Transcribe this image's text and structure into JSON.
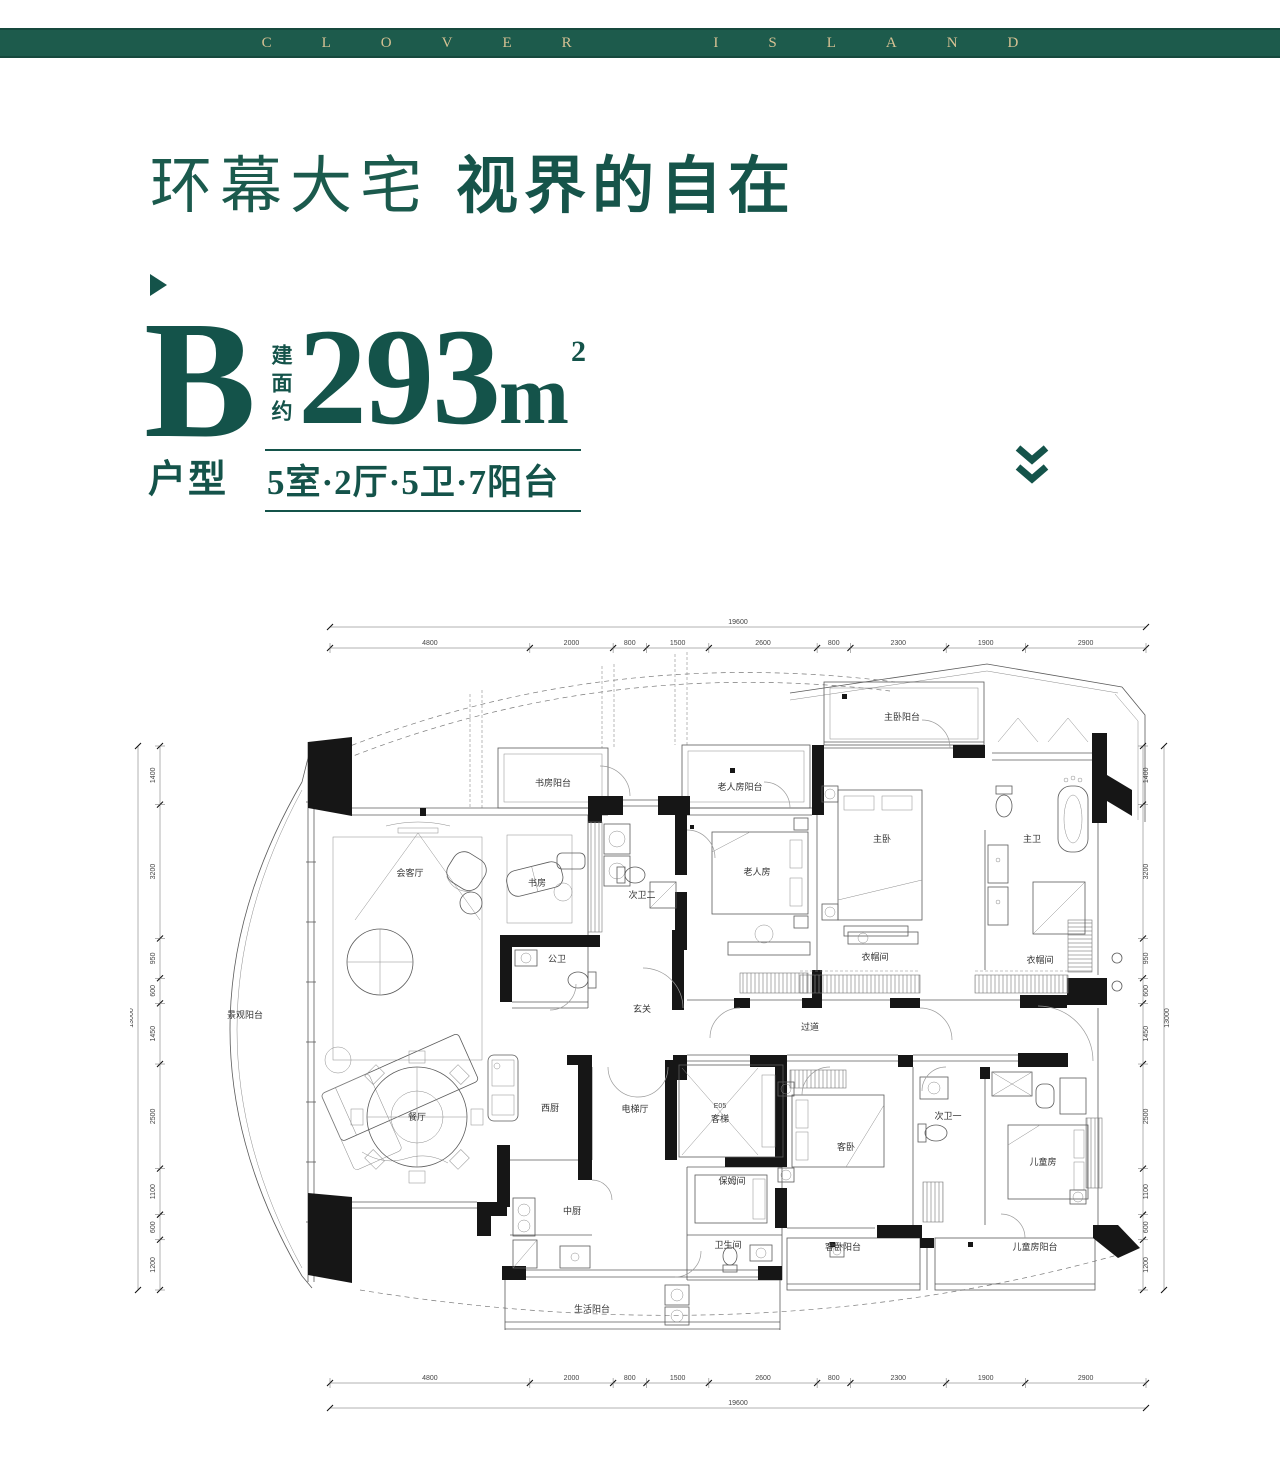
{
  "brand": {
    "name": "CLOVER ISLAND"
  },
  "title": {
    "light": "环幕大宅",
    "heavy": "视界的自在"
  },
  "unit": {
    "letter": "B",
    "type_label": "户型",
    "area_prefix": "建面约",
    "area_value": "293",
    "area_unit": "m",
    "area_sup": "2",
    "layout": "5室·2厅·5卫·7阳台"
  },
  "accent_color": "#14534a",
  "bar_color": "#1d5b4c",
  "gold_color": "#d6c193",
  "plan": {
    "rooms": [
      "景观阳台",
      "会客厅",
      "书房",
      "书房阳台",
      "次卫二",
      "公卫",
      "玄关",
      "老人房阳台",
      "老人房",
      "主卧阳台",
      "主卧",
      "主卫",
      "衣帽间",
      "衣帽间",
      "过道",
      "餐厅",
      "西厨",
      "电梯厅",
      "保姆间",
      "中厨",
      "卫生间",
      "生活阳台",
      "客卧",
      "次卫一",
      "儿童房",
      "客卧阳台",
      "儿童房阳台"
    ],
    "elevator": {
      "code": "E05",
      "label": "客梯"
    },
    "dimensions": {
      "top": {
        "total": 19600,
        "segments": [
          4800,
          2000,
          800,
          1500,
          2600,
          800,
          2300,
          1900,
          2900
        ]
      },
      "bottom": {
        "total": 19600,
        "segments": [
          4800,
          2000,
          800,
          1500,
          2600,
          800,
          2300,
          1900,
          2900
        ]
      },
      "left": {
        "total": 13000,
        "segments": [
          1400,
          3200,
          950,
          600,
          1450,
          2500,
          1100,
          600,
          1200
        ]
      },
      "right": {
        "total": 13000,
        "segments": [
          1400,
          3200,
          950,
          600,
          1450,
          2500,
          1100,
          600,
          1200
        ]
      }
    }
  }
}
